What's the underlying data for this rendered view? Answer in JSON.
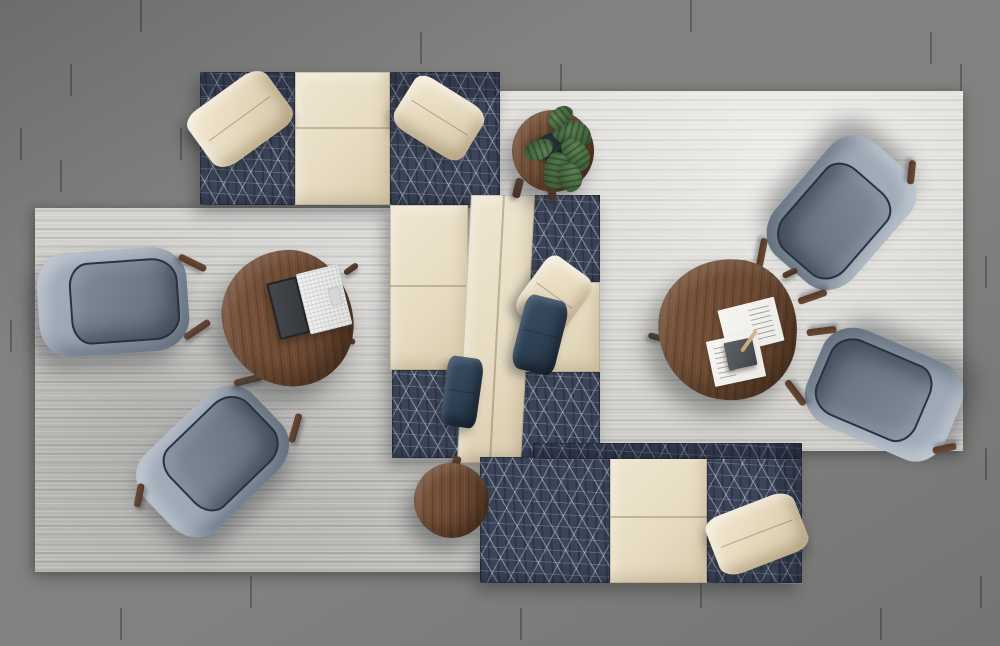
{
  "scene": {
    "title": "Top-down render of a modern office lounge seating arrangement",
    "floor": {
      "material": "gray wood planks"
    },
    "rugs": [
      {
        "name": "left area rug",
        "color": "#c6c5c2"
      },
      {
        "name": "right area rug",
        "color": "#d8d7d3"
      }
    ],
    "furniture": [
      {
        "name": "top modular sofa",
        "upholstery": "navy geometric pattern with cream center seat",
        "pillows": [
          "cream",
          "cream"
        ]
      },
      {
        "name": "center back-to-back bench",
        "upholstery": "cream and navy geometric modules",
        "pillows": [
          "cream",
          "navy",
          "navy"
        ]
      },
      {
        "name": "bottom modular sofa",
        "upholstery": "navy geometric pattern with cream seat",
        "pillows": [
          "cream"
        ]
      },
      {
        "name": "lounge armchair upper-left",
        "fabric": "light blue-gray"
      },
      {
        "name": "lounge armchair lower-left",
        "fabric": "light blue-gray"
      },
      {
        "name": "lounge armchair upper-right",
        "fabric": "light blue-gray"
      },
      {
        "name": "lounge armchair lower-right",
        "fabric": "light blue-gray"
      },
      {
        "name": "pebble coffee table left",
        "material": "walnut",
        "items": [
          "open laptop"
        ]
      },
      {
        "name": "pebble coffee table right",
        "material": "walnut",
        "items": [
          "two papers",
          "dark notebook",
          "pencil"
        ]
      },
      {
        "name": "round side table with monstera plant",
        "material": "walnut"
      },
      {
        "name": "round side table",
        "material": "walnut"
      }
    ],
    "palette": {
      "floor_base": "#81817f",
      "floor_dark": "#747472",
      "floor_light": "#8e8e8c",
      "rug_left": "#c6c5c2",
      "rug_right": "#d8d7d3",
      "navy": "#3b4458",
      "cream": "#e7dcc3",
      "cream_dark": "#d9ccae",
      "chair_shell": "#93a0ae",
      "chair_shell_light": "#a9b3c0",
      "chair_well": "#6e7987",
      "piping": "#2a323f",
      "walnut": "#6d4a33",
      "walnut_dark": "#583b28",
      "leg_wood": "#53392a",
      "pillow_navy": "#2e4154",
      "plant_dark": "#3c5a37",
      "plant_light": "#5d8454",
      "pot": "#1e2633",
      "paper": "#ecebe7",
      "notebook": "#4e5256",
      "laptop_screen": "#34373b",
      "laptop_base": "#e2e4e3",
      "pencil": "#d9ba8e"
    }
  }
}
